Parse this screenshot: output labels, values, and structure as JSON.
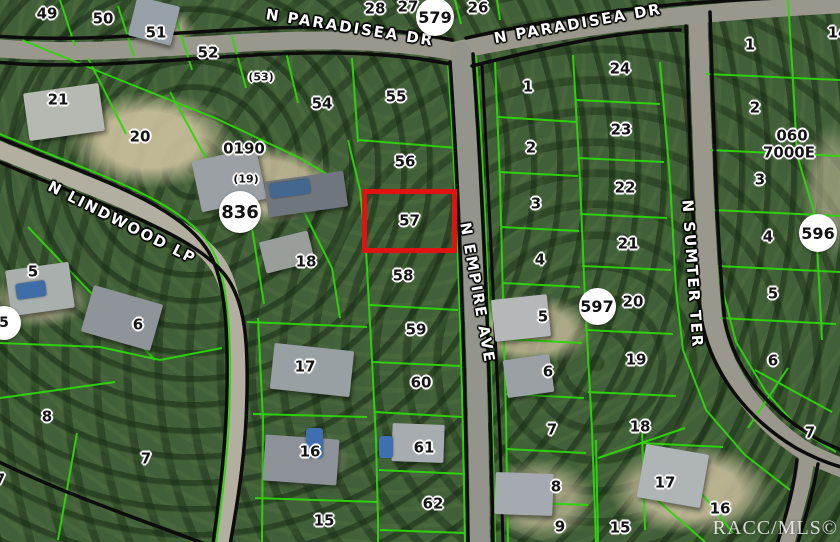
{
  "map": {
    "description": "Aerial MLS parcel map with lot boundaries",
    "watermark": "RACC/MLS©",
    "colors": {
      "parcel_line": "#2ed60a",
      "road_edge": "#0c0c0c",
      "road_fill": "#9a988c",
      "highlight": "#e01212",
      "lot_text": "#141414",
      "lot_halo": "#ffffff",
      "street_text": "#ffffff",
      "badge_bg": "#ffffff"
    },
    "highlight": {
      "label": "57",
      "x": 362,
      "y": 189,
      "w": 95,
      "h": 64,
      "color": "#e01212"
    },
    "streets": [
      {
        "t": "N PARADISEA DR",
        "x": 350,
        "y": 28,
        "r": 9
      },
      {
        "t": "N PARADISEA DR",
        "x": 578,
        "y": 24,
        "r": -10
      },
      {
        "t": "N LINDWOOD LP",
        "x": 122,
        "y": 223,
        "r": 27
      },
      {
        "t": "N EMPIRE AVE",
        "x": 477,
        "y": 293,
        "r": 80
      },
      {
        "t": "N SUMTER TER",
        "x": 692,
        "y": 274,
        "r": 86
      }
    ],
    "badges": [
      {
        "t": "579",
        "x": 435,
        "y": 17,
        "d": 38
      },
      {
        "t": "836",
        "x": 240,
        "y": 212,
        "d": 42
      },
      {
        "t": "597",
        "x": 597,
        "y": 306,
        "d": 37
      },
      {
        "t": "596",
        "x": 818,
        "y": 233,
        "d": 38
      },
      {
        "t": "5",
        "x": 4,
        "y": 323,
        "d": 34
      }
    ],
    "lots": [
      {
        "t": "49",
        "x": 47,
        "y": 14
      },
      {
        "t": "50",
        "x": 103,
        "y": 19
      },
      {
        "t": "51",
        "x": 156,
        "y": 33
      },
      {
        "t": "52",
        "x": 208,
        "y": 53
      },
      {
        "t": "(53)",
        "x": 261,
        "y": 77,
        "s": 1
      },
      {
        "t": "54",
        "x": 322,
        "y": 104
      },
      {
        "t": "55",
        "x": 396,
        "y": 97
      },
      {
        "t": "21",
        "x": 58,
        "y": 100
      },
      {
        "t": "20",
        "x": 140,
        "y": 137
      },
      {
        "t": "0190",
        "x": 244,
        "y": 149
      },
      {
        "t": "(19)",
        "x": 246,
        "y": 179,
        "s": 1
      },
      {
        "t": "18",
        "x": 306,
        "y": 262
      },
      {
        "t": "5",
        "x": 33,
        "y": 272
      },
      {
        "t": "6",
        "x": 138,
        "y": 325
      },
      {
        "t": "8",
        "x": 47,
        "y": 417
      },
      {
        "t": "7",
        "x": 146,
        "y": 459
      },
      {
        "t": "7",
        "x": 0,
        "y": 480
      },
      {
        "t": "56",
        "x": 405,
        "y": 162
      },
      {
        "t": "58",
        "x": 403,
        "y": 276
      },
      {
        "t": "59",
        "x": 416,
        "y": 330
      },
      {
        "t": "60",
        "x": 421,
        "y": 383
      },
      {
        "t": "61",
        "x": 424,
        "y": 448
      },
      {
        "t": "62",
        "x": 433,
        "y": 504
      },
      {
        "t": "17",
        "x": 305,
        "y": 367
      },
      {
        "t": "16",
        "x": 310,
        "y": 452
      },
      {
        "t": "15",
        "x": 324,
        "y": 521
      },
      {
        "t": "28",
        "x": 375,
        "y": 9
      },
      {
        "t": "27",
        "x": 408,
        "y": 7
      },
      {
        "t": "26",
        "x": 478,
        "y": 8
      },
      {
        "t": "1",
        "x": 528,
        "y": 87
      },
      {
        "t": "2",
        "x": 531,
        "y": 148
      },
      {
        "t": "3",
        "x": 536,
        "y": 204
      },
      {
        "t": "4",
        "x": 540,
        "y": 260
      },
      {
        "t": "5",
        "x": 543,
        "y": 317
      },
      {
        "t": "6",
        "x": 548,
        "y": 372
      },
      {
        "t": "7",
        "x": 552,
        "y": 430
      },
      {
        "t": "8",
        "x": 556,
        "y": 487
      },
      {
        "t": "9",
        "x": 560,
        "y": 527
      },
      {
        "t": "24",
        "x": 620,
        "y": 69
      },
      {
        "t": "23",
        "x": 621,
        "y": 130
      },
      {
        "t": "22",
        "x": 625,
        "y": 188
      },
      {
        "t": "21",
        "x": 628,
        "y": 244
      },
      {
        "t": "20",
        "x": 633,
        "y": 302
      },
      {
        "t": "19",
        "x": 636,
        "y": 360
      },
      {
        "t": "18",
        "x": 640,
        "y": 427
      },
      {
        "t": "17",
        "x": 665,
        "y": 483
      },
      {
        "t": "16",
        "x": 720,
        "y": 509
      },
      {
        "t": "15",
        "x": 620,
        "y": 528
      },
      {
        "t": "1",
        "x": 750,
        "y": 45
      },
      {
        "t": "14",
        "x": 838,
        "y": 33
      },
      {
        "t": "2",
        "x": 755,
        "y": 108
      },
      {
        "t": "060",
        "x": 792,
        "y": 136
      },
      {
        "t": "7000E",
        "x": 789,
        "y": 153
      },
      {
        "t": "3",
        "x": 760,
        "y": 180
      },
      {
        "t": "4",
        "x": 768,
        "y": 237
      },
      {
        "t": "5",
        "x": 773,
        "y": 294
      },
      {
        "t": "6",
        "x": 773,
        "y": 361
      },
      {
        "t": "7",
        "x": 810,
        "y": 433
      }
    ]
  }
}
